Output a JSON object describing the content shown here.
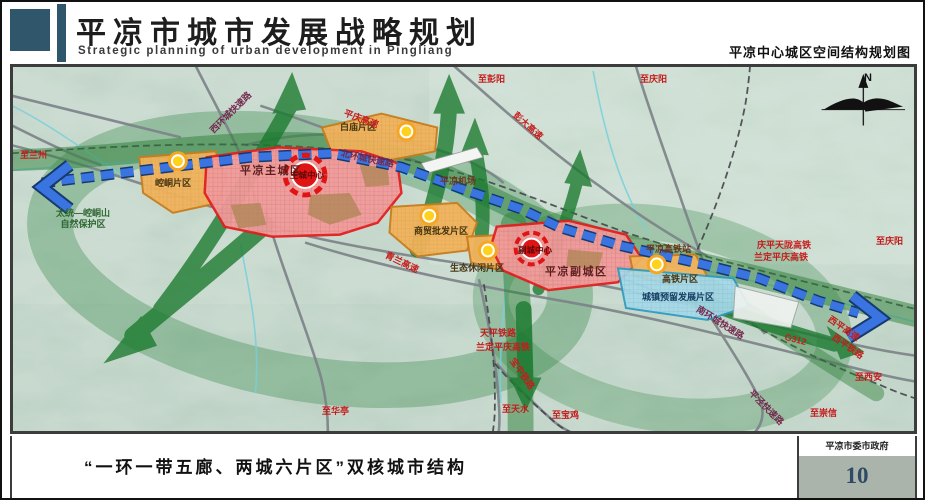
{
  "header": {
    "title": "平凉市城市发展战略规划",
    "subtitle": "Strategic planning of urban development in Pingliang",
    "map_name": "平凉中心城区空间结构规划图"
  },
  "footer": {
    "caption": "“一环一带五廊、两城六片区”双核城市结构",
    "authority": "平凉市委市政府",
    "page_number": "10"
  },
  "colors": {
    "header_block": "#30566b",
    "page_number": "#2e4a66",
    "zone_pink": "#f19b9b",
    "zone_orange": "#f2b35c",
    "zone_blue": "#a6d9e8",
    "band_blue": "#3a74e0",
    "corridor_green": "#1a7a2e",
    "center_red": "#e01414"
  },
  "map": {
    "labels": [
      {
        "id": "to-lanzhou",
        "t": "至兰州",
        "x": 8,
        "y": 84,
        "c": "red"
      },
      {
        "id": "nature-reserve",
        "t": "太统—崆峒山\n自然保护区",
        "x": 44,
        "y": 142,
        "c": "green"
      },
      {
        "id": "kongtong-district",
        "t": "崆峒片区",
        "x": 143,
        "y": 112,
        "c": "zone"
      },
      {
        "id": "main-city",
        "t": "平凉主城区",
        "x": 228,
        "y": 99,
        "c": "zoneBig"
      },
      {
        "id": "main-center",
        "t": "主城中心",
        "x": 273,
        "y": 104,
        "c": "center"
      },
      {
        "id": "baimiao-district",
        "t": "白庙片区",
        "x": 328,
        "y": 56,
        "c": "zone"
      },
      {
        "id": "west-ring-expwy",
        "t": "西环城快速路",
        "x": 196,
        "y": 62,
        "c": "maroon",
        "r": -45
      },
      {
        "id": "north-ring-expwy",
        "t": "北环城快速路",
        "x": 330,
        "y": 82,
        "c": "maroon",
        "r": 12
      },
      {
        "id": "pingqing-expwy",
        "t": "平庆高速",
        "x": 334,
        "y": 42,
        "c": "red",
        "r": 20
      },
      {
        "id": "to-pengyang",
        "t": "至彭阳",
        "x": 466,
        "y": 8,
        "c": "red"
      },
      {
        "id": "pengda-expwy",
        "t": "彭大高速",
        "x": 506,
        "y": 44,
        "c": "red",
        "r": 42
      },
      {
        "id": "to-qingyang-north",
        "t": "至庆阳",
        "x": 628,
        "y": 8,
        "c": "red"
      },
      {
        "id": "airport-label",
        "t": "平凉机场",
        "x": 428,
        "y": 110,
        "c": "station"
      },
      {
        "id": "qinglan-expwy",
        "t": "青兰高速",
        "x": 376,
        "y": 184,
        "c": "red",
        "r": 26
      },
      {
        "id": "trade-district",
        "t": "商贸批发片区",
        "x": 402,
        "y": 160,
        "c": "zone"
      },
      {
        "id": "leisure-district",
        "t": "生态休闲片区",
        "x": 438,
        "y": 197,
        "c": "zone"
      },
      {
        "id": "sub-center",
        "t": "副城中心",
        "x": 501,
        "y": 179,
        "c": "center"
      },
      {
        "id": "sub-city",
        "t": "平凉副城区",
        "x": 533,
        "y": 200,
        "c": "zoneBig"
      },
      {
        "id": "hsr-station",
        "t": "平凉高铁站",
        "x": 634,
        "y": 178,
        "c": "station"
      },
      {
        "id": "qingping-tianlong-hsr",
        "t": "庆平天陇高铁",
        "x": 745,
        "y": 174,
        "c": "red"
      },
      {
        "id": "landing-pingqing-hsr",
        "t": "兰定平庆高铁",
        "x": 742,
        "y": 186,
        "c": "red"
      },
      {
        "id": "to-qingyang-east",
        "t": "至庆阳",
        "x": 864,
        "y": 170,
        "c": "red"
      },
      {
        "id": "hsr-district",
        "t": "高铁片区",
        "x": 650,
        "y": 208,
        "c": "zone"
      },
      {
        "id": "reserved-district",
        "t": "城镇预留发展片区",
        "x": 630,
        "y": 226,
        "c": "navy"
      },
      {
        "id": "south-ring-expwy",
        "t": "南环城快速路",
        "x": 688,
        "y": 238,
        "c": "maroon",
        "r": 32
      },
      {
        "id": "g312",
        "t": "G312",
        "x": 774,
        "y": 266,
        "c": "red",
        "r": 14
      },
      {
        "id": "xiping-expwy",
        "t": "西平高速",
        "x": 820,
        "y": 248,
        "c": "red",
        "r": 35
      },
      {
        "id": "xiping-railway",
        "t": "西平铁路",
        "x": 824,
        "y": 266,
        "c": "red",
        "r": 35
      },
      {
        "id": "to-xian",
        "t": "至西安",
        "x": 843,
        "y": 306,
        "c": "red"
      },
      {
        "id": "pingjing-expwy",
        "t": "平泾快速路",
        "x": 742,
        "y": 322,
        "c": "maroon",
        "r": 45
      },
      {
        "id": "to-chongxin",
        "t": "至崇信",
        "x": 798,
        "y": 342,
        "c": "red"
      },
      {
        "id": "to-huating",
        "t": "至华亭",
        "x": 310,
        "y": 340,
        "c": "red"
      },
      {
        "id": "tianping-railway",
        "t": "天平铁路",
        "x": 468,
        "y": 262,
        "c": "red"
      },
      {
        "id": "landing-pingqing-hsr-sw",
        "t": "兰定平庆高铁",
        "x": 464,
        "y": 276,
        "c": "red"
      },
      {
        "id": "baozhong-railway",
        "t": "宝中铁路",
        "x": 504,
        "y": 290,
        "c": "red",
        "r": 55
      },
      {
        "id": "to-tianshui",
        "t": "至天水",
        "x": 490,
        "y": 338,
        "c": "red"
      },
      {
        "id": "to-baoji",
        "t": "至宝鸡",
        "x": 540,
        "y": 344,
        "c": "red"
      },
      {
        "id": "compass-n",
        "t": "N",
        "x": 852,
        "y": 6,
        "c": "compass"
      }
    ]
  }
}
